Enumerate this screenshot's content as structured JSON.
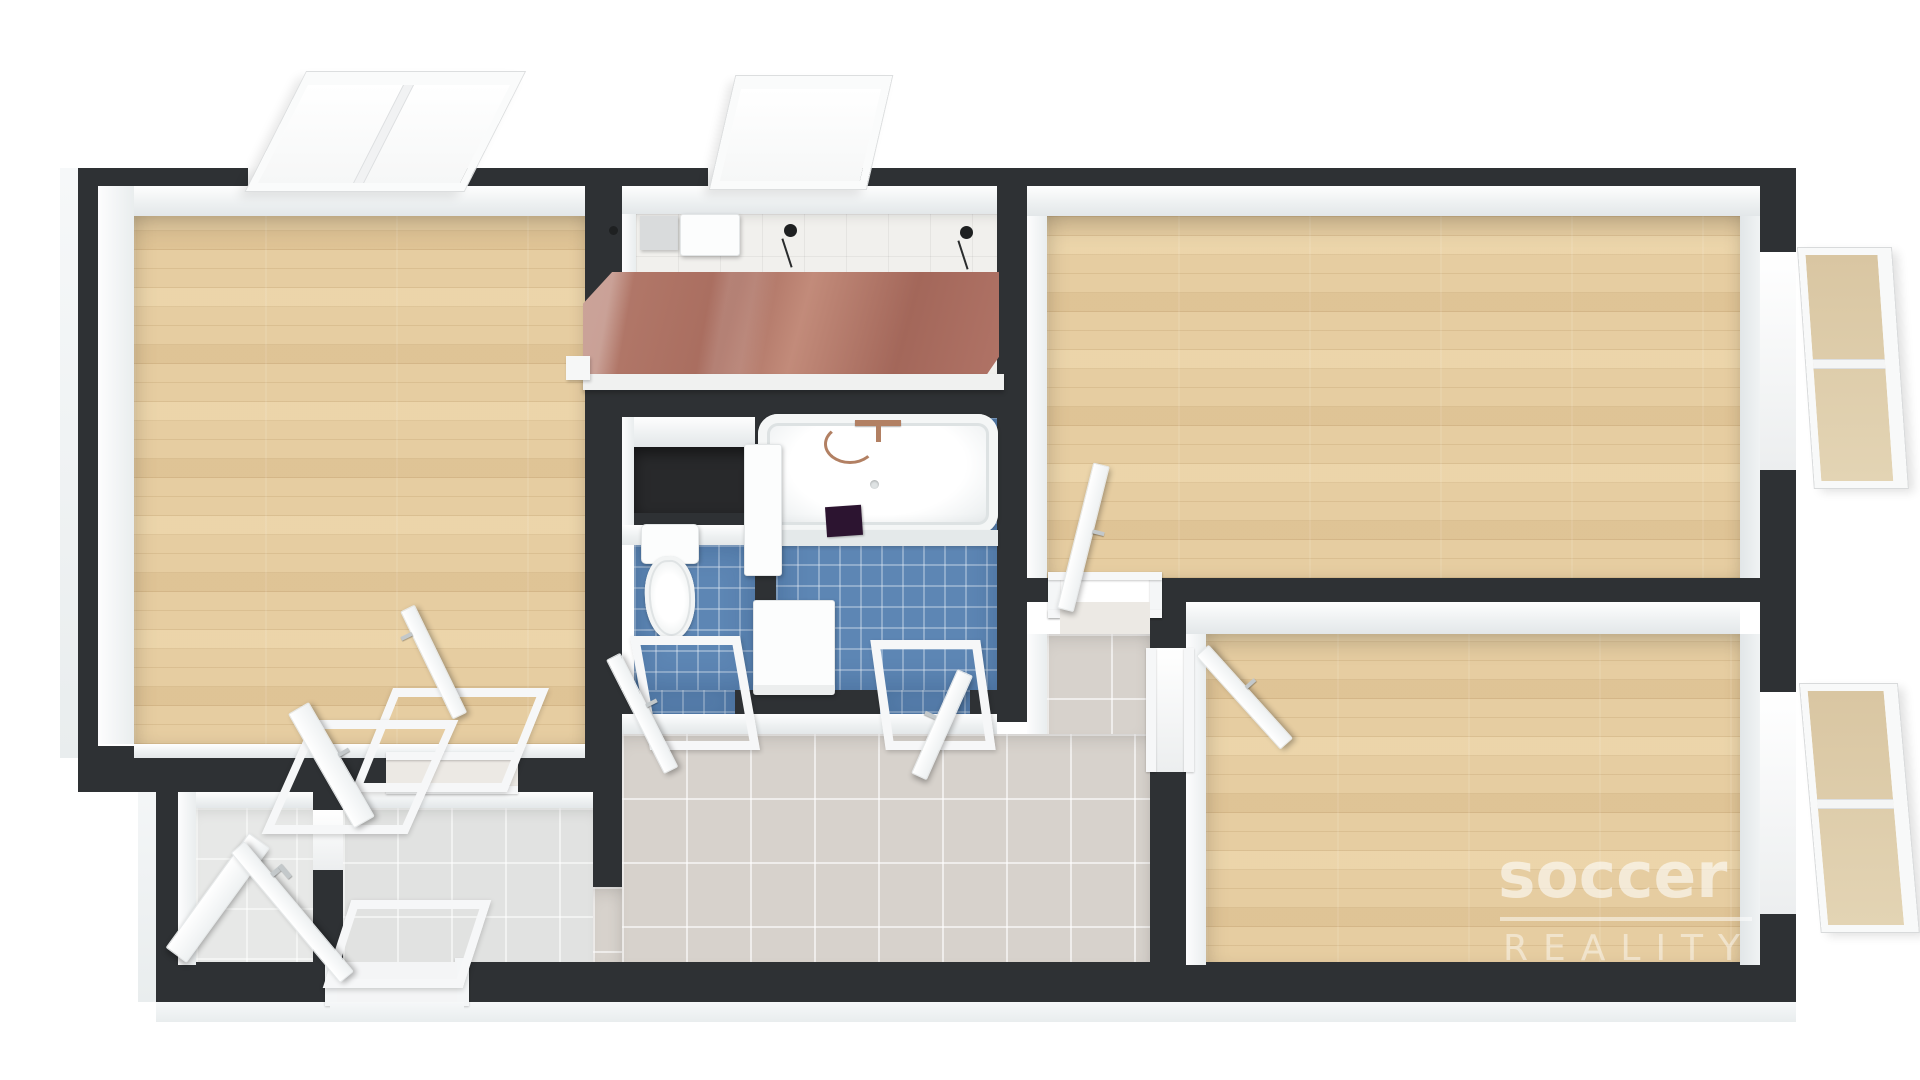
{
  "watermark": {
    "brand": "soccer",
    "subtitle": "REALITY"
  },
  "scene": {
    "type": "3d-floorplan-render",
    "rooms": [
      {
        "name": "living-room",
        "floor": "wood"
      },
      {
        "name": "kitchen",
        "floor": "white-tile",
        "feature": "terracotta-cabinets"
      },
      {
        "name": "storage-niche",
        "floor": "dark"
      },
      {
        "name": "wc",
        "floor": "blue-mosaic",
        "feature": "toilet"
      },
      {
        "name": "bathroom",
        "floor": "blue-mosaic",
        "feature": "bathtub"
      },
      {
        "name": "hallway",
        "floor": "beige-tile"
      },
      {
        "name": "entry-room-left",
        "floor": "gray-tile"
      },
      {
        "name": "entry-room-middle",
        "floor": "gray-tile"
      },
      {
        "name": "bedroom-right",
        "floor": "wood"
      },
      {
        "name": "bedroom-bottom-right",
        "floor": "wood"
      }
    ],
    "window_count": 4,
    "door_count": 8
  },
  "colors": {
    "wall": "#2e3134",
    "wood": "#e6cda1",
    "tile_blue": "#5d86b4",
    "tile_hall": "#d7d2cc",
    "tile_entry": "#e1e2e1",
    "tile_entry_light": "#e7e8e7",
    "kitchen_floor": "#f1f0ed",
    "cabinet": "#ae7264",
    "cabinet_light": "#c28b7a",
    "fixture": "#fcfdfd",
    "mat": "#2c1430",
    "storage": "#28292b",
    "glass_tan": "#d9c6a2",
    "page_bg": "#ffffff",
    "watermark": "#ffffff"
  }
}
